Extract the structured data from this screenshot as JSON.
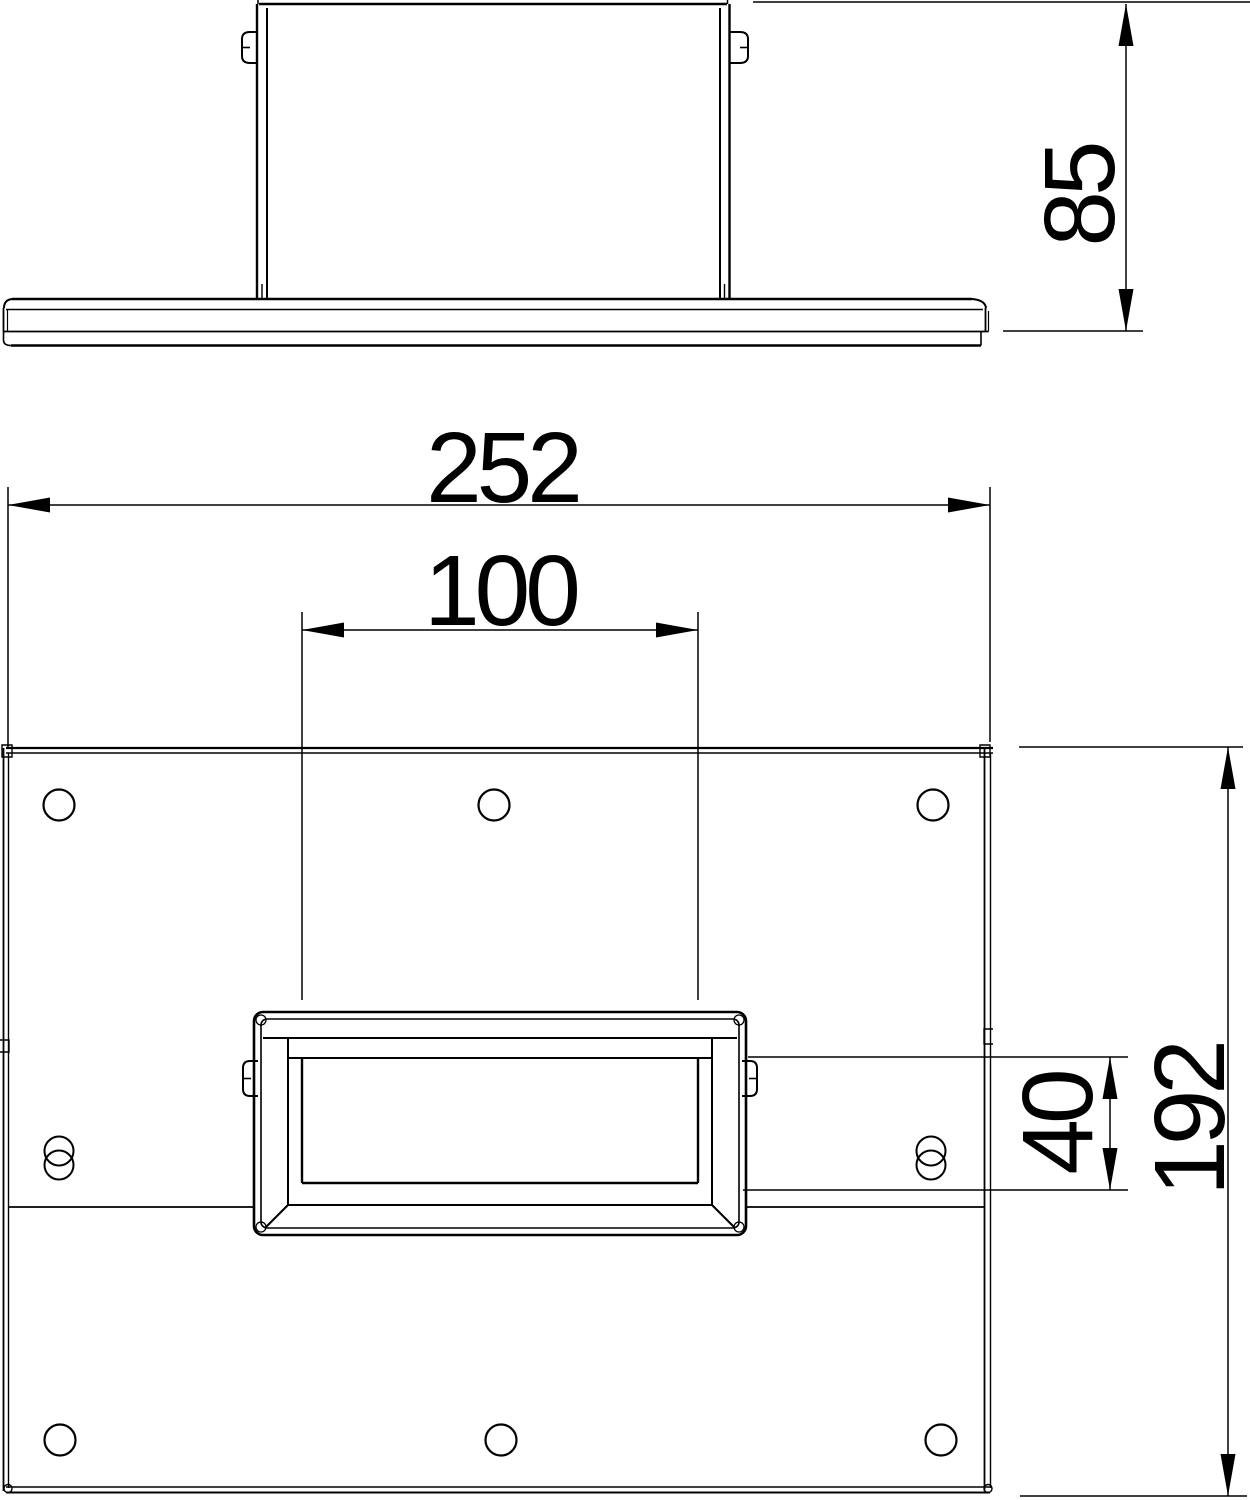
{
  "drawing": {
    "type": "technical-dimension-drawing",
    "dimensions": {
      "side_height": "85",
      "overall_width": "252",
      "opening_width": "100",
      "opening_height": "40",
      "overall_depth": "192"
    },
    "counts": {
      "round_holes": 6,
      "slotted_holes": 2
    },
    "colors": {
      "line": "#000000",
      "background": "#ffffff"
    }
  }
}
